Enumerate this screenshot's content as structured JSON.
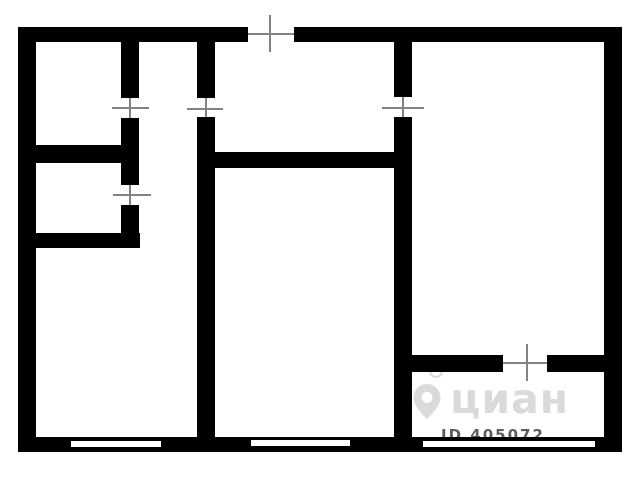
{
  "canvas": {
    "width": 640,
    "height": 480,
    "background": "#ffffff"
  },
  "colors": {
    "wall": "#000000",
    "door_line": "#828282",
    "window_slot": "#ffffff",
    "watermark_brand": "#dadada",
    "watermark_id": "#5c5c5c"
  },
  "walls": [
    {
      "name": "outer-wall-top-left-segment",
      "x": 18,
      "y": 27,
      "w": 230,
      "h": 15
    },
    {
      "name": "outer-wall-top-right-segment",
      "x": 294,
      "y": 27,
      "w": 328,
      "h": 15
    },
    {
      "name": "outer-wall-left",
      "x": 18,
      "y": 27,
      "w": 18,
      "h": 425
    },
    {
      "name": "outer-wall-right",
      "x": 604,
      "y": 27,
      "w": 18,
      "h": 425
    },
    {
      "name": "outer-wall-bottom",
      "x": 18,
      "y": 437,
      "w": 604,
      "h": 15
    },
    {
      "name": "inner-wall-v1-upper",
      "x": 121,
      "y": 42,
      "w": 18,
      "h": 56
    },
    {
      "name": "inner-wall-v1-middle",
      "x": 121,
      "y": 118,
      "w": 18,
      "h": 67
    },
    {
      "name": "inner-wall-v1-lower",
      "x": 121,
      "y": 205,
      "w": 18,
      "h": 43
    },
    {
      "name": "inner-wall-v2-upper",
      "x": 197,
      "y": 42,
      "w": 18,
      "h": 56
    },
    {
      "name": "inner-wall-v2-main",
      "x": 197,
      "y": 117,
      "w": 18,
      "h": 320
    },
    {
      "name": "inner-wall-v3-upper",
      "x": 394,
      "y": 42,
      "w": 18,
      "h": 55
    },
    {
      "name": "inner-wall-v3-main",
      "x": 394,
      "y": 117,
      "w": 18,
      "h": 320
    },
    {
      "name": "inner-wall-left-upper-divider",
      "x": 18,
      "y": 145,
      "w": 121,
      "h": 18
    },
    {
      "name": "inner-wall-left-lower-divider",
      "x": 18,
      "y": 233,
      "w": 122,
      "h": 15
    },
    {
      "name": "inner-wall-center-divider",
      "x": 197,
      "y": 152,
      "w": 215,
      "h": 16
    },
    {
      "name": "inner-wall-right-divider-a",
      "x": 412,
      "y": 355,
      "w": 91,
      "h": 17
    },
    {
      "name": "inner-wall-right-divider-b",
      "x": 547,
      "y": 355,
      "w": 57,
      "h": 17
    }
  ],
  "window_slots": [
    {
      "name": "window-left-room",
      "x": 71,
      "y": 441,
      "w": 90,
      "h": 6
    },
    {
      "name": "window-center-room",
      "x": 251,
      "y": 440,
      "w": 99,
      "h": 6
    },
    {
      "name": "window-right-room",
      "x": 423,
      "y": 441,
      "w": 172,
      "h": 6
    }
  ],
  "door_symbols": [
    {
      "name": "opening-top-balcony",
      "lines": [
        {
          "x": 248,
          "y": 33,
          "w": 46,
          "h": 2
        },
        {
          "x": 269,
          "y": 15,
          "w": 2,
          "h": 37
        }
      ]
    },
    {
      "name": "opening-top-left-room",
      "lines": [
        {
          "x": 129,
          "y": 98,
          "w": 2,
          "h": 20
        },
        {
          "x": 112,
          "y": 107,
          "w": 37,
          "h": 2
        }
      ]
    },
    {
      "name": "opening-left-small-room",
      "lines": [
        {
          "x": 129,
          "y": 185,
          "w": 2,
          "h": 20
        },
        {
          "x": 113,
          "y": 194,
          "w": 38,
          "h": 2
        }
      ]
    },
    {
      "name": "opening-corridor",
      "lines": [
        {
          "x": 205,
          "y": 98,
          "w": 2,
          "h": 19
        },
        {
          "x": 187,
          "y": 108,
          "w": 36,
          "h": 2
        }
      ]
    },
    {
      "name": "opening-right-room",
      "lines": [
        {
          "x": 402,
          "y": 97,
          "w": 2,
          "h": 20
        },
        {
          "x": 382,
          "y": 107,
          "w": 42,
          "h": 2
        }
      ]
    },
    {
      "name": "opening-right-loggia",
      "lines": [
        {
          "x": 503,
          "y": 362,
          "w": 44,
          "h": 2
        },
        {
          "x": 526,
          "y": 344,
          "w": 2,
          "h": 37
        }
      ]
    }
  ],
  "watermark": {
    "brand": "циан",
    "id": "ID 405072"
  }
}
